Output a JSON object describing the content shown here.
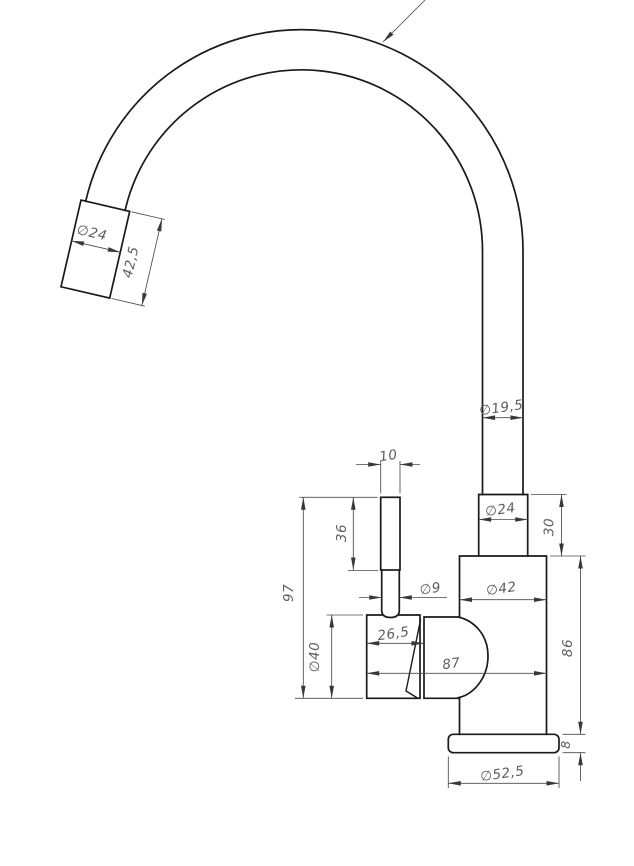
{
  "drawing": {
    "type": "technical-drawing",
    "subject": "kitchen-faucet-side-view",
    "line_colors": {
      "outline": "#1a1a1a",
      "dimension": "#4a4a4a",
      "text": "#5d5d5d"
    },
    "dimensions": {
      "spray_head_diameter": "∅24",
      "spray_head_length": "42,5",
      "tube_diameter": "∅19,5",
      "lever_cap_width": "10",
      "lever_cap_height": "36",
      "stem_diameter": "∅9",
      "lever_overall_height": "97",
      "handle_body_diameter": "∅40",
      "handle_body_depth": "26,5",
      "overall_depth": "87",
      "connector_diameter": "∅24",
      "connector_height": "30",
      "body_diameter": "∅42",
      "body_height": "86",
      "base_flange_thickness": "8",
      "base_flange_diameter": "∅52,5"
    }
  }
}
